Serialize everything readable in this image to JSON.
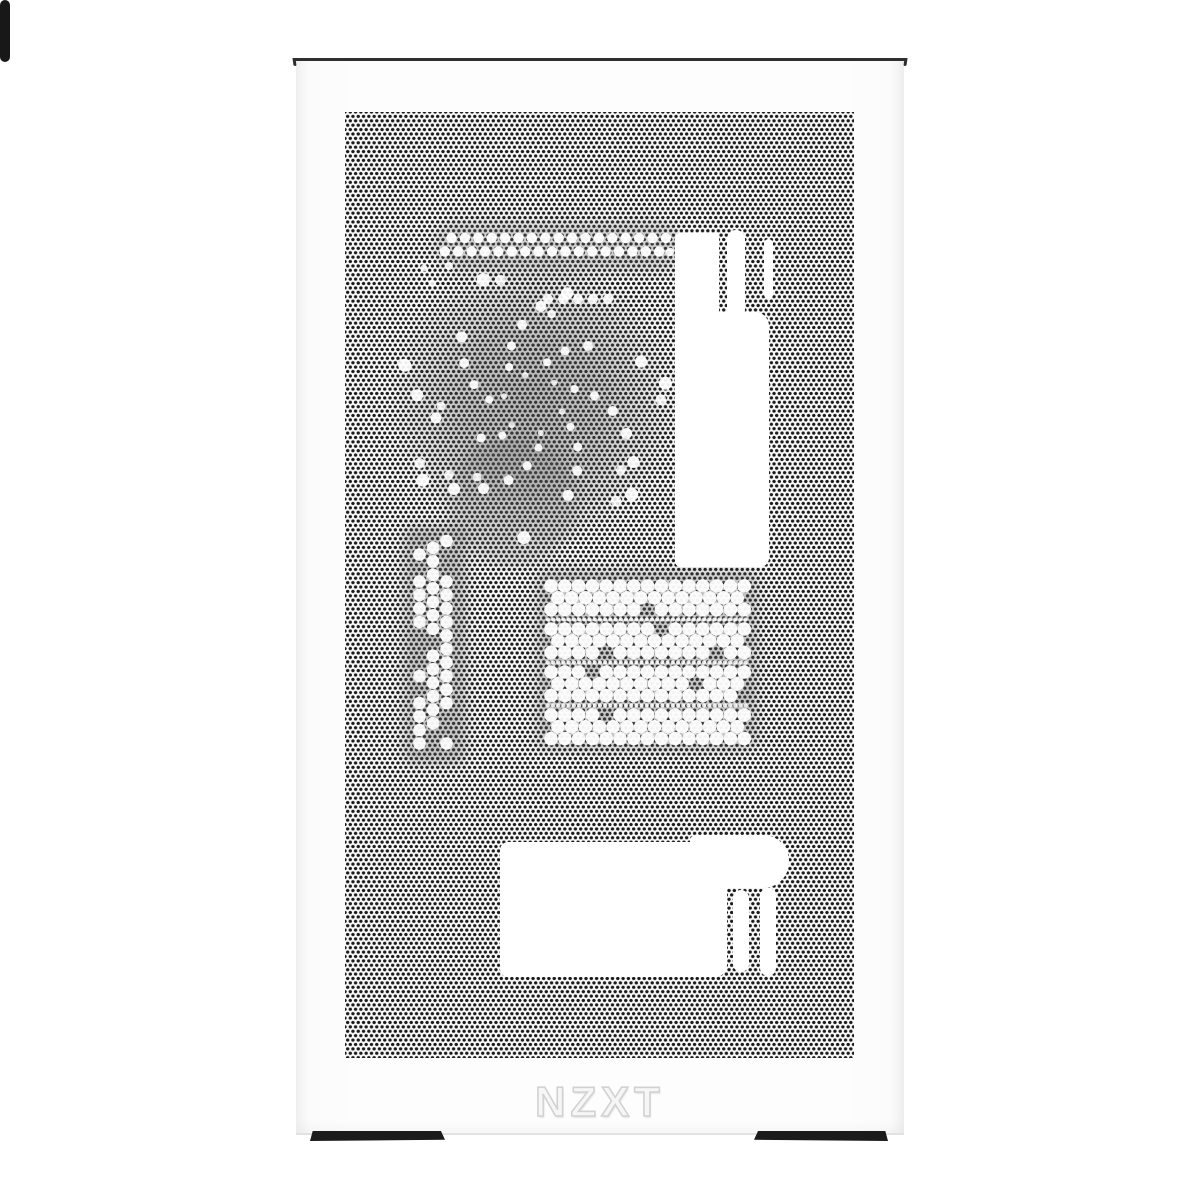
{
  "brand": {
    "logo": "NZXT"
  },
  "colors": {
    "background": "#ffffff",
    "panel_face": "#fbfbfb",
    "mesh_dot": "#1a1a1a",
    "top_edge": "#2f2f2f",
    "foot": "#1b1b1b",
    "cutout_white": "#ffffff",
    "logo_text": "#f6f6f6"
  }
}
